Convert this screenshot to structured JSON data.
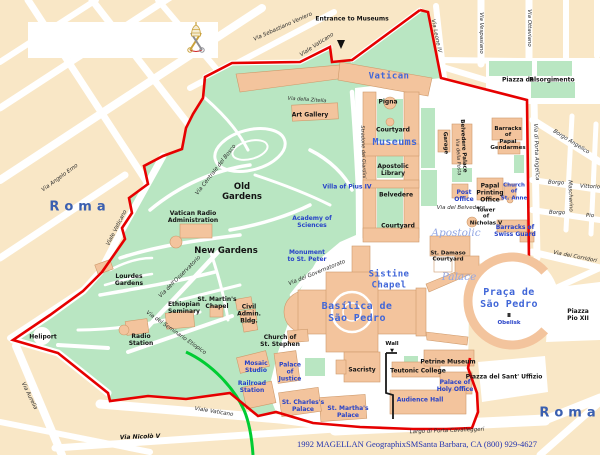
{
  "map": {
    "colors": {
      "block_tan": "#F9E7C6",
      "street_white": "#FFFFFF",
      "park_green": "#B9E6C2",
      "building_peach": "#F3C49D",
      "boundary_red": "#E60000",
      "railway_green": "#00CC33",
      "wall_black": "#1A1A1A",
      "minor_label_blue": "#2742C8",
      "feature_label_blue": "#4066D8",
      "roma_label_blue": "#3A5FB0"
    },
    "icons": {
      "vatican_crest": "papal-tiara-crossed-keys",
      "entrance_arrow": "down-arrow",
      "wall_arrow": "down-arrow",
      "obelisk_marker": "small-square-dot"
    }
  },
  "labels": {
    "entrance_to_museums": "Entrance to Museums",
    "via_sebastiano_veniero": "Via Sebastiano Veniero",
    "viale_vaticano_top": "Viale Vaticano",
    "viale_vaticano_left": "Viale Vaticano",
    "viale_vaticano_bottom": "Viale Vaticano",
    "via_angelo_emo": "Via Angelo Emo",
    "via_aurelia": "Via Aurelia",
    "via_nicolo_v": "Via Nicolò V",
    "via_leone_iv": "Via Leone IV",
    "via_vespasiano": "Via Vespasiano",
    "via_ottaviano": "Via Ottaviano",
    "piazza_del": "Piazza del",
    "risorgimento": "Risorgimento",
    "borgo_angelico": "Borgo Angelico",
    "via_di_porta_angelica": "Via di Porta Angelica",
    "borgo_vittorio_left": "Borgo",
    "borgo_vittorio_right": "Vittorio",
    "mascherino": "Mascherino",
    "borgo_pio_left": "Borgo",
    "borgo_pio_right": "Pio",
    "via_dei_corridori": "Via dei Corridori",
    "piazza_pio_xii": "Piazza Pio XII",
    "piazza_sant_uffizio": "Piazza  del  Sant' Uffizio",
    "largo_porta_cavalleggeri": "Largo di Porta Cavalleggeri",
    "roma_left": "Roma",
    "roma_right": "Roma",
    "old_gardens": "Old\nGardens",
    "new_gardens": "New  Gardens",
    "vatican_radio_administration": "Vatican Radio\nAdministration",
    "lourdes_gardens": "Lourdes\nGardens",
    "heliport": "Heliport",
    "ethiopian_seminary": "Ethiopian\nSeminary",
    "st_martins_chapel": "St. Martin's\nChapel",
    "civil_admin_bldg": "Civil\nAdmin.\nBldg.",
    "radio_station": "Radio\nStation",
    "church_of_st_stephen": "Church of\nSt. Stephen",
    "mosaic_studio": "Mosaic\nStudio",
    "palace_of_justice": "Palace\nof\nJustice",
    "railroad_station": "Railroad\nStation",
    "st_charless_palace": "St. Charles's\nPalace",
    "st_marthas_palace": "St. Martha's\nPalace",
    "sacristy": "Sacristy",
    "teutonic_college": "Teutonic  College",
    "petrine_museum": "Petrine Museum",
    "wall": "Wall",
    "wall_arrow": "▼",
    "palace_of_holy_office": "Palace of\nHoly Office",
    "audience_hall": "Audience  Hall",
    "obelisk": "Obelisk",
    "praca_de_sao_pedro": "Praça de\nSão Pedro",
    "basilica_de_sao_pedro": "Basílica de\nSão Pedro",
    "sistine_chapel": "Sistine\nChapel",
    "apostolic": "Apostolic",
    "palace": "Palace",
    "st_damaso_courtyard": "St. Damaso\nCourtyard",
    "tower_of_nicholas_v": "Tower\nof\nNicholas V",
    "barracks_of_swiss_guard": "Barracks of\nSwiss Guard",
    "church_of_st_anne": "Church\nof\nSt. Anne",
    "papal_printing_office": "Papal\nPrinting\nOffice",
    "post_office": "Post\nOffice",
    "via_del_belvedere": "Via del Belvedere",
    "via_della_posta": "Via della Posta",
    "garage": "Garage",
    "belvedere_palace": "Belvedere  Palace",
    "barracks_of_papal_gendarmes": "Barracks\nof\nPapal\nGendarmes",
    "vatican": "Vatican",
    "museums": "Museums",
    "pigna": "Pigna",
    "courtyard_north": "Courtyard",
    "apostolic_library": "Apostolic\nLibrary",
    "belvedere": "Belvedere",
    "courtyard_south": "Courtyard",
    "art_gallery": "Art Gallery",
    "via_della_zitella": "Via della Zitella",
    "stradone_dei_giardini": "Stradone dei Giardini",
    "villa_of_pius_iv": "Villa of Pius IV",
    "academy_of_sciences": "Academy of\nSciences",
    "monument_to_st_peter": "Monument\nto St. Peter",
    "via_del_governatorato": "Via del Governatorato",
    "via_centrale_del_bosco": "Via Centrale del Bosco",
    "via_dell_osservatorio": "Via dell'Osservatorio",
    "via_del_seminario_etiopico": "Via del Seminario Etiopico",
    "copyright": "1992 MAGELLAN GeographixSMSanta Barbara, CA (800) 929-4627"
  }
}
